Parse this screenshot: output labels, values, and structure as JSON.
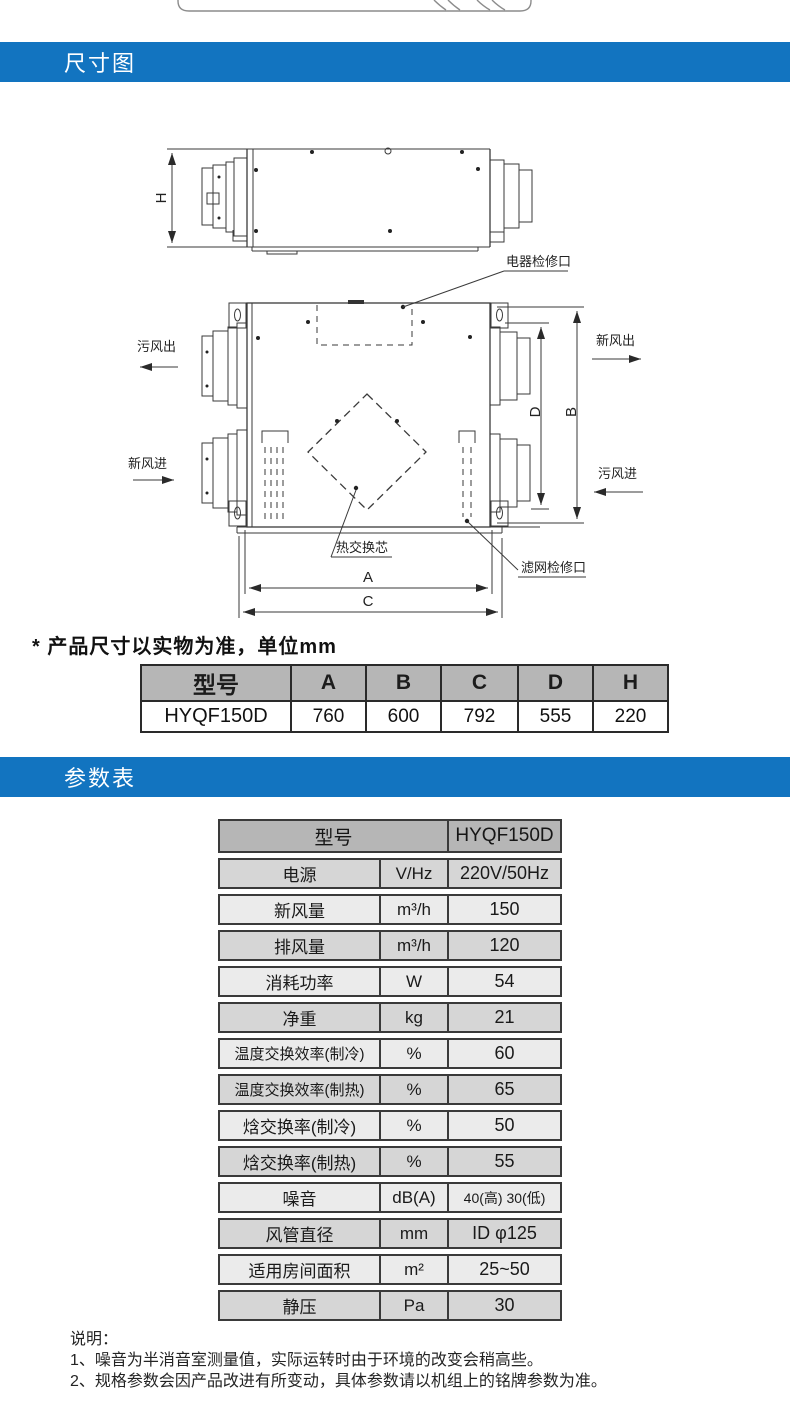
{
  "colors": {
    "accent_blue": "#1274c0",
    "table_header_gray": "#b6b6b6",
    "param_row_dark": "#d6d6d6",
    "param_row_light": "#ebebeb"
  },
  "sections": {
    "dimensions": {
      "title": "尺寸图"
    },
    "parameters": {
      "title": "参数表"
    }
  },
  "diagram": {
    "dims": {
      "h": "H",
      "a": "A",
      "b": "B",
      "c": "C",
      "d": "D"
    },
    "labels": {
      "electric_access": "电器检修口",
      "dirty_air_out": "污风出",
      "fresh_air_out": "新风出",
      "fresh_air_in": "新风进",
      "dirty_air_in": "污风进",
      "heat_exchange_core": "热交换芯",
      "filter_access": "滤网检修口"
    }
  },
  "dimension_note": "* 产品尺寸以实物为准，单位mm",
  "dimension_table": {
    "headers": [
      "型号",
      "A",
      "B",
      "C",
      "D",
      "H"
    ],
    "row": {
      "model": "HYQF150D",
      "a": "760",
      "b": "600",
      "c": "792",
      "d": "555",
      "h": "220"
    }
  },
  "parameter_table": {
    "header": {
      "label": "型号",
      "value": "HYQF150D"
    },
    "rows": [
      {
        "name": "电源",
        "unit": "V/Hz",
        "value": "220V/50Hz"
      },
      {
        "name": "新风量",
        "unit": "m³/h",
        "value": "150"
      },
      {
        "name": "排风量",
        "unit": "m³/h",
        "value": "120"
      },
      {
        "name": "消耗功率",
        "unit": "W",
        "value": "54"
      },
      {
        "name": "净重",
        "unit": "kg",
        "value": "21"
      },
      {
        "name": "温度交换效率(制冷)",
        "unit": "%",
        "value": "60"
      },
      {
        "name": "温度交换效率(制热)",
        "unit": "%",
        "value": "65"
      },
      {
        "name": "焓交换率(制冷)",
        "unit": "%",
        "value": "50"
      },
      {
        "name": "焓交换率(制热)",
        "unit": "%",
        "value": "55"
      },
      {
        "name": "噪音",
        "unit": "dB(A)",
        "value": "40(高) 30(低)"
      },
      {
        "name": "风管直径",
        "unit": "mm",
        "value": "ID φ125"
      },
      {
        "name": "适用房间面积",
        "unit": "m²",
        "value": "25~50"
      },
      {
        "name": "静压",
        "unit": "Pa",
        "value": "30"
      }
    ]
  },
  "notes": {
    "title": "说明：",
    "items": [
      "1、噪音为半消音室测量值，实际运转时由于环境的改变会稍高些。",
      "2、规格参数会因产品改进有所变动，具体参数请以机组上的铭牌参数为准。"
    ]
  }
}
